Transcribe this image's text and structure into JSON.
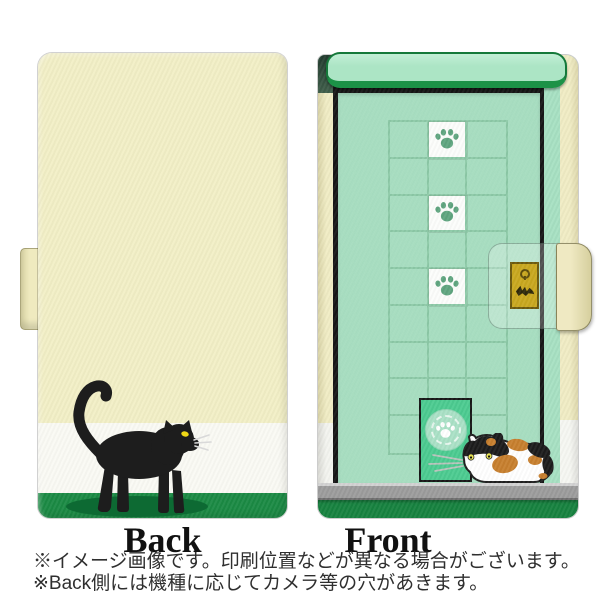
{
  "product_image": {
    "type": "flip phone case, cat door design",
    "back_panel": {
      "label": "Back",
      "art": [
        "black-cat-illustration",
        "cat-shadow-ellipse"
      ]
    },
    "front_panel": {
      "label": "Front",
      "art": [
        "door-awning",
        "paw-print-grid",
        "cat-flap-door",
        "gold-lock-plate",
        "magnetic-flap-tab",
        "calico-cat-illustration"
      ],
      "grid": {
        "cols": 3,
        "rows": 9,
        "paw_cells": [
          [
            0,
            1
          ],
          [
            2,
            1
          ],
          [
            4,
            1
          ]
        ]
      }
    },
    "notes": {
      "line1": "※イメージ画像です。印刷位置などが異なる場合がございます。",
      "line2": "※Back側には機種に応じてカメラ等の穴があきます。"
    }
  },
  "icons": {
    "paw": "paw-print-icon",
    "keyhole": "keyhole-icon",
    "key": "key-icon"
  },
  "colors": {
    "back-body": "#f2efc6",
    "back-band": "#fafaf4",
    "back-ground": "#1b8a44",
    "cat-black": "#1d1d1d",
    "cat-shadow": "#0d6a33",
    "cat-eye": "#f0d816",
    "front-door": "#a7e0c2",
    "front-awning": "#ace5c5",
    "awning-border": "#15793a",
    "awning-lip": "#1c9247",
    "frame-black": "#161616",
    "spine-cream": "#f0ecc4",
    "grid-line": "#8cc9a7",
    "paw-green": "#5fa57f",
    "catflap-green": "#4ccb90",
    "lock-gold": "#c9a81f",
    "lock-border": "#6d5a0d",
    "floor-gray": "#9c9c9c",
    "front-ground": "#17823f",
    "calico-orange": "#c77f2e",
    "calico-eye": "#e9e44f"
  }
}
